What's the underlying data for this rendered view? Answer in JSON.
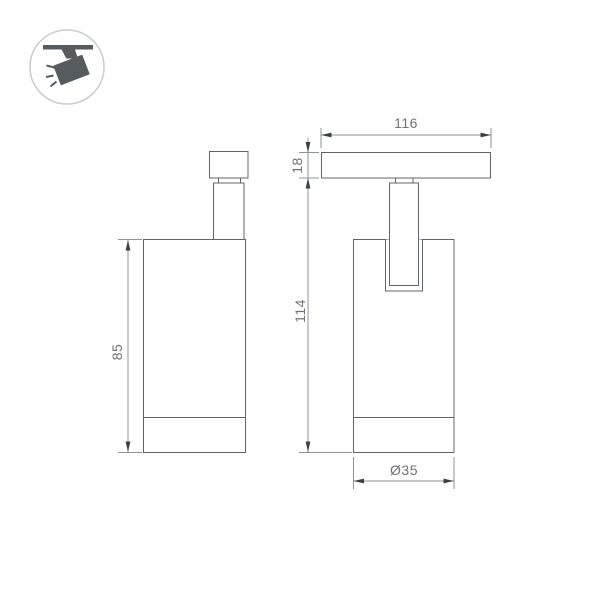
{
  "title": "Track spotlight technical drawing",
  "icon": {
    "label": "ceiling-track-spotlight-pictogram"
  },
  "views": {
    "front_view": {
      "name": "front view of cylindrical track spotlight",
      "dim_body_height": "85"
    },
    "side_view": {
      "name": "side view with track adapter",
      "dim_track_width": "116",
      "dim_track_height": "18",
      "dim_total_height": "114",
      "dim_body_diameter": "Ø35"
    }
  },
  "colors": {
    "background": "#ffffff",
    "part_outline": "#606468",
    "dimension_line": "#909397",
    "arrow": "#3c4043",
    "dimension_text": "#6f7276",
    "icon_glyph": "#565b5f",
    "icon_circle": "#c9cccf"
  }
}
